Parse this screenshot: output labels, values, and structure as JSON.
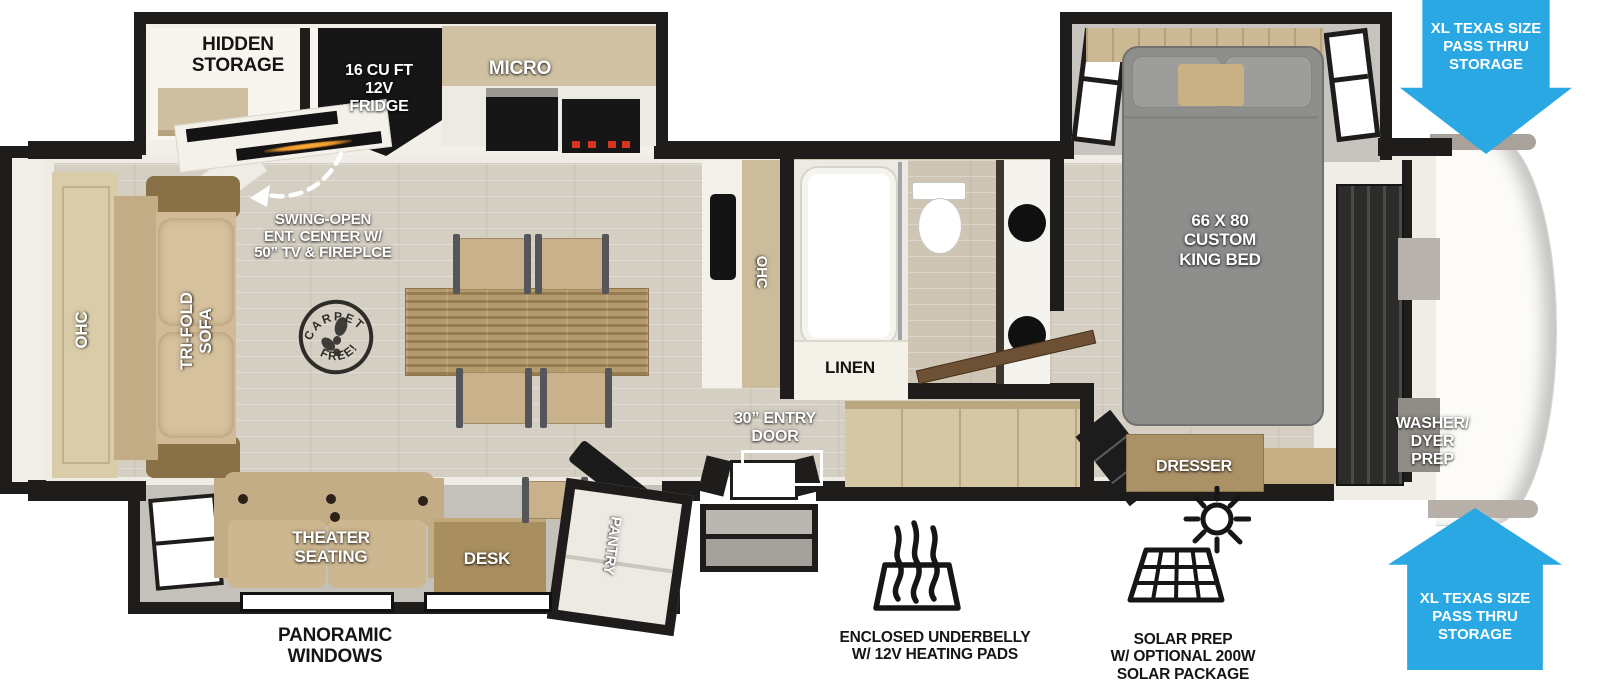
{
  "colors": {
    "wall": "#1e1d1b",
    "floor_wood": "#d5cfc3",
    "slide_floor_gray": "#c4c1bb",
    "cabinet_tan": "#cdbfa0",
    "callout_blue": "#29a8e4",
    "flame_orange": "#e8912a",
    "burner_red": "#d63322",
    "bed_gray": "#8e8e8c"
  },
  "rooms": {
    "kitchen": {
      "hidden_storage": "HIDDEN\nSTORAGE",
      "fridge": "16 CU FT\n12V\nFRIDGE",
      "micro": "MICRO",
      "overhead_cabinet": "OHC",
      "swing_note": "SWING-OPEN\nENT. CENTER W/\n50” TV & FIREPLCE"
    },
    "living": {
      "overhead_cabinet": "OHC",
      "sofa": "TRI-FOLD\nSOFA",
      "stamp_arc_top": "CARPET",
      "stamp_arc_bottom": "FREE!",
      "theater": "THEATER\nSEATING",
      "desk": "DESK",
      "pantry": "PANTRY"
    },
    "entry": {
      "door": "30” ENTRY\nDOOR"
    },
    "bath": {
      "linen": "LINEN"
    },
    "bedroom": {
      "bed": "66 X 80\nCUSTOM\nKING BED",
      "dresser": "DRESSER",
      "washer_prep": "WASHER/\nDYER\nPREP"
    }
  },
  "callouts": {
    "pass_thru_top": "XL TEXAS SIZE\nPASS THRU\nSTORAGE",
    "pass_thru_bottom": "XL TEXAS SIZE\nPASS THRU\nSTORAGE",
    "panoramic_windows": "PANORAMIC\nWINDOWS",
    "underbelly": "ENCLOSED UNDERBELLY\nW/ 12V HEATING PADS",
    "solar": "SOLAR PREP\nW/ OPTIONAL 200W\nSOLAR PACKAGE"
  }
}
